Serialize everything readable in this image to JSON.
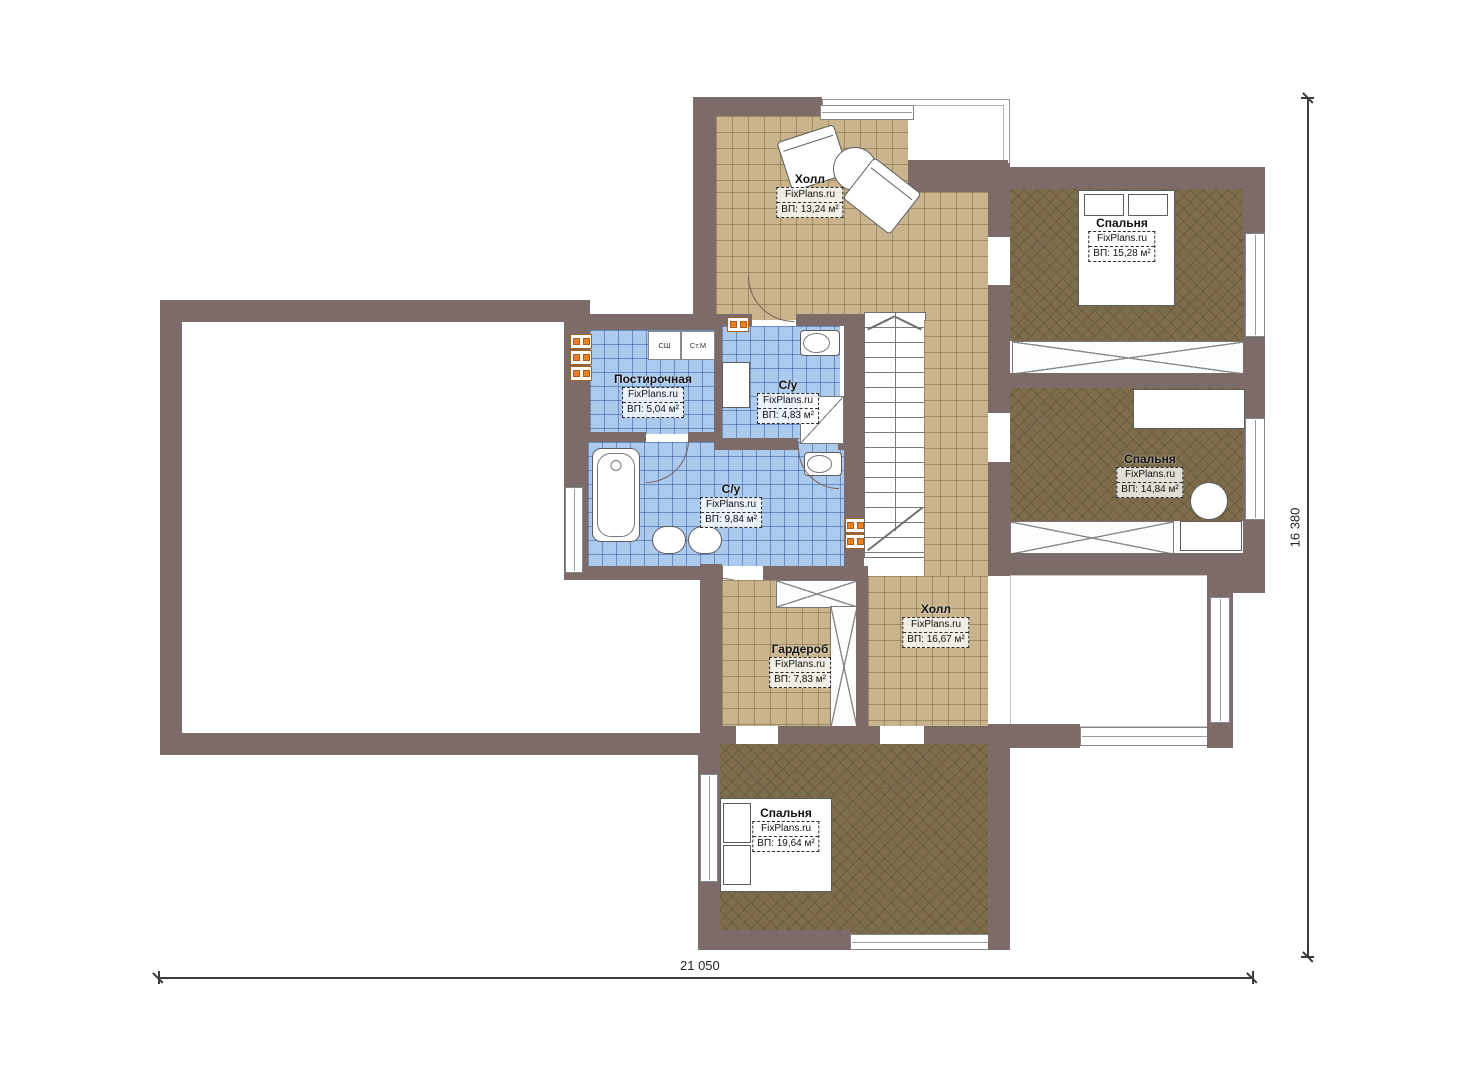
{
  "plan": {
    "watermark": "FixPlans.ru",
    "dim_width": "21 050",
    "dim_height": "16 380",
    "rooms": [
      {
        "name": "Холл",
        "watermark": "FixPlans.ru",
        "area": "ВП: 13,24 м²"
      },
      {
        "name": "Спальня",
        "watermark": "FixPlans.ru",
        "area": "ВП: 15,28 м²"
      },
      {
        "name": "Постирочная",
        "watermark": "FixPlans.ru",
        "area": "ВП: 5,04 м²"
      },
      {
        "name": "С/у",
        "watermark": "FixPlans.ru",
        "area": "ВП: 4,83 м²"
      },
      {
        "name": "С/у",
        "watermark": "FixPlans.ru",
        "area": "ВП: 9,84 м²"
      },
      {
        "name": "Спальня",
        "watermark": "FixPlans.ru",
        "area": "ВП: 14,84 м²"
      },
      {
        "name": "Холл",
        "watermark": "FixPlans.ru",
        "area": "ВП: 16,67 м²"
      },
      {
        "name": "Гардероб",
        "watermark": "FixPlans.ru",
        "area": "ВП: 7,83 м²"
      },
      {
        "name": "Спальня",
        "watermark": "FixPlans.ru",
        "area": "ВП: 19,64 м²"
      }
    ],
    "appliances": [
      {
        "label": "СШ"
      },
      {
        "label": "Ст.М"
      }
    ],
    "colors": {
      "wall": "#7c6b69",
      "floor-tile": "#c9b48d",
      "floor-bedroom": "#7d6d4c",
      "floor-wet": "#abcaee",
      "radiator": "#f07f1f"
    }
  }
}
